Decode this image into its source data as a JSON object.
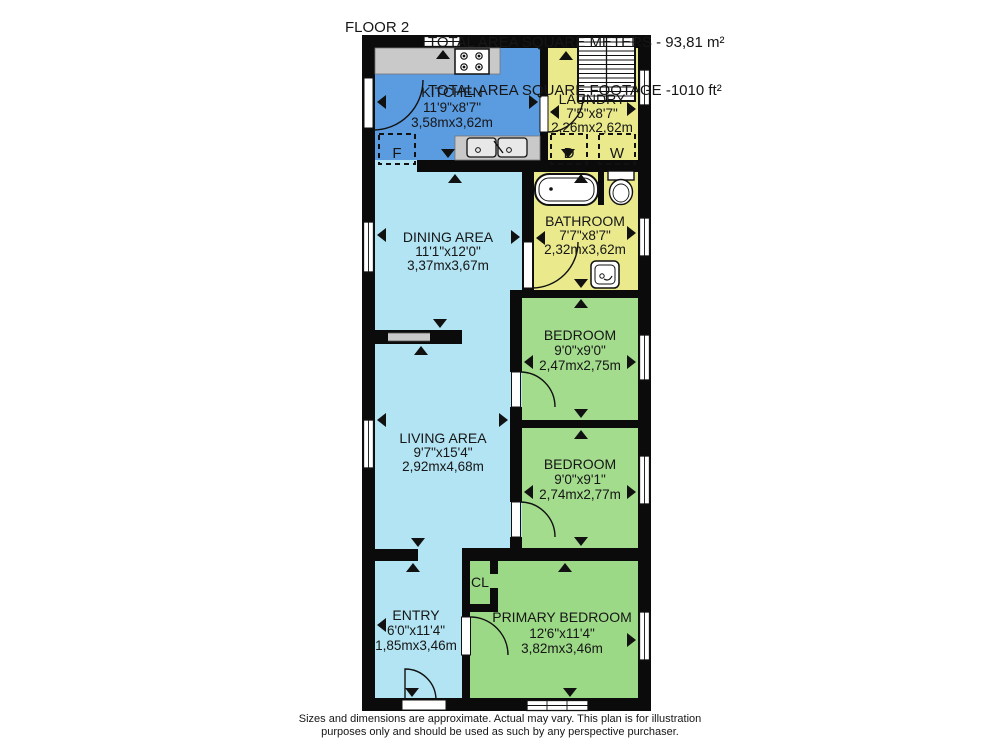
{
  "header": {
    "floor_label": "FLOOR 2",
    "total_line1": "TOTAL AREA SQUARE METERS - 93,81 m²",
    "total_line2": "TOTAL AREA SQUARE FOOTAGE -1010 ft²"
  },
  "footer": {
    "line1": "Sizes and dimensions are approximate. Actual may vary. This plan is for illustration",
    "line2": "purposes only and should be used as such by any perspective purchaser."
  },
  "rooms": [
    {
      "name": "KITCHEN",
      "imperial": "11'9\"x8'7\"",
      "metric": "3,58mx3,62m"
    },
    {
      "name": "LAUNDRY",
      "imperial": "7'5\"x8'7\"",
      "metric": "2,26mx2,62m"
    },
    {
      "name": "BATHROOM",
      "imperial": "7'7\"x8'7\"",
      "metric": "2,32mx3,62m"
    },
    {
      "name": "DINING AREA",
      "imperial": "11'1\"x12'0\"",
      "metric": "3,37mx3,67m"
    },
    {
      "name": "BEDROOM",
      "imperial": "9'0\"x9'0\"",
      "metric": "2,47mx2,75m"
    },
    {
      "name": "BEDROOM",
      "imperial": "9'0\"x9'1\"",
      "metric": "2,74mx2,77m"
    },
    {
      "name": "LIVING AREA",
      "imperial": "9'7\"x15'4\"",
      "metric": "2,92mx4,68m"
    },
    {
      "name": "ENTRY",
      "imperial": "6'0\"x11'4\"",
      "metric": "1,85mx3,46m"
    },
    {
      "name": "PRIMARY BEDROOM",
      "imperial": "12'6\"x11'4\"",
      "metric": "3,82mx3,46m"
    }
  ],
  "labels": {
    "closet": "CL",
    "fridge": "F",
    "dryer": "D",
    "washer": "W"
  },
  "colors": {
    "wall_black": "#0b0b0b",
    "kitchen_blue": "#5B9BE0",
    "room_light_blue": "#B2E4F3",
    "wet_room_yellow": "#EAEA8C",
    "bedroom_green": "#A3DC8D",
    "primary_bedroom_green": "#9CD986",
    "counter_gray": "#C9C9C9"
  }
}
